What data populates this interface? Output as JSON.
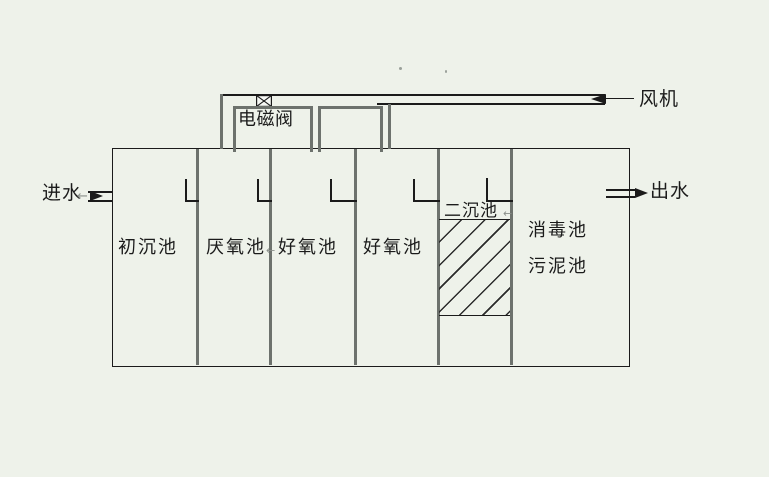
{
  "diagram": {
    "labels": {
      "inlet": "进水",
      "outlet": "出水",
      "blower": "风机",
      "solenoid_valve": "电磁阀"
    },
    "tanks": [
      {
        "label": "初沉池"
      },
      {
        "label": "厌氧池"
      },
      {
        "label": "好氧池"
      },
      {
        "label": "好氧池"
      },
      {
        "label": "二沉池"
      },
      {
        "label": "消毒池"
      },
      {
        "label": "污泥池"
      }
    ],
    "icons": {
      "small_arrow": "←"
    },
    "colors": {
      "background": "#eef2ea",
      "line": "#1b1b1b",
      "divider": "#6d726d"
    }
  }
}
